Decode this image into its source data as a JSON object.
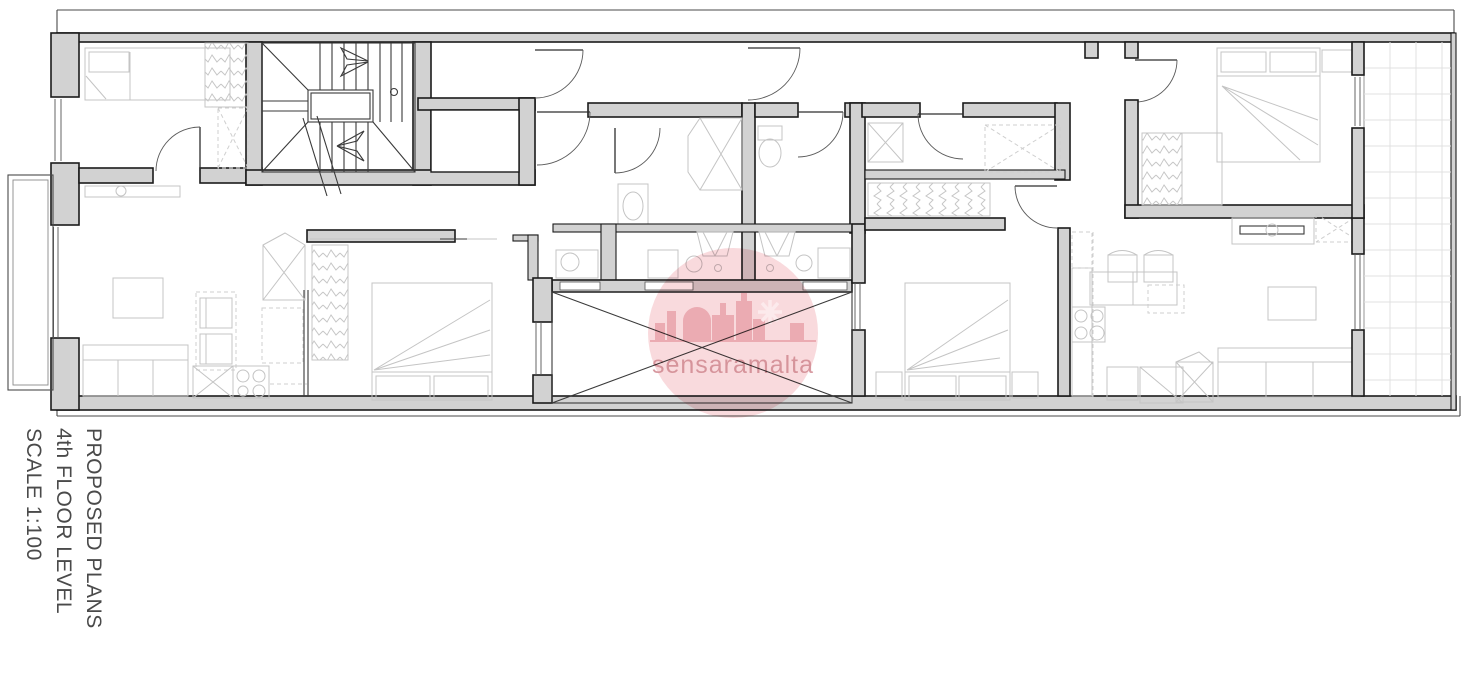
{
  "document": {
    "type": "architectural floor plan drawing",
    "plan_title": "PROPOSED PLANS",
    "floor_label": "4th FLOOR LEVEL",
    "scale_label": "SCALE 1:100"
  },
  "title_block": {
    "lines": [
      "PROPOSED PLANS",
      "4th FLOOR LEVEL",
      "SCALE 1:100"
    ],
    "color": "#4a4a4a"
  },
  "watermark": {
    "text": "sensaramalta",
    "circle_color": "#f4b6bc",
    "skyline_color": "#e79fa7",
    "text_color": "#d08890"
  },
  "plan_style": {
    "wall_fill": "#d2d2d2",
    "wall_outline": "#1b1b1b",
    "furniture_line": "#c4c4c4",
    "stair_line": "#3a3a3a",
    "tile_line": "#e0e0e0"
  }
}
